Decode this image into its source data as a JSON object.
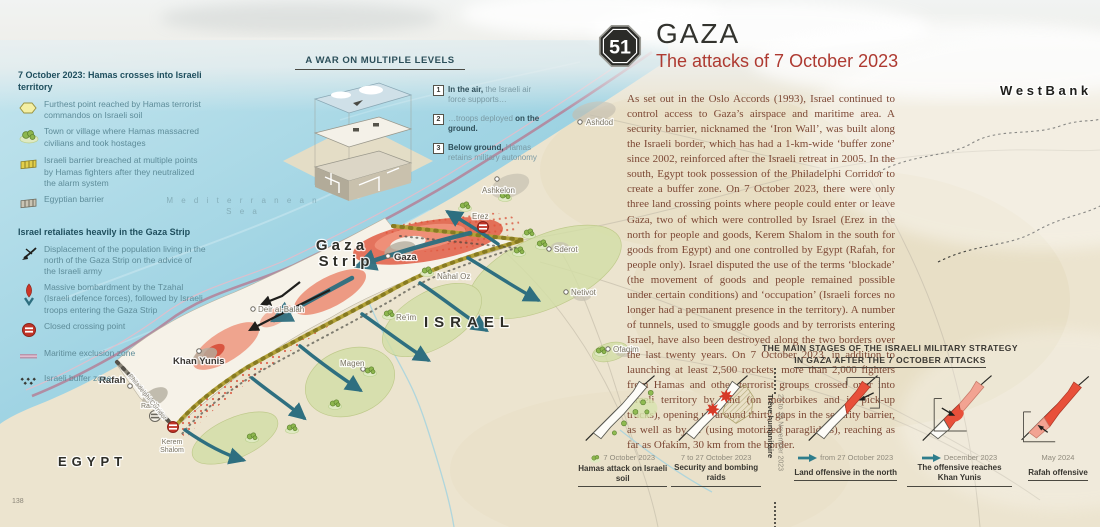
{
  "page": {
    "number": "138"
  },
  "title": {
    "badge": "51",
    "region": "GAZA",
    "subtitle": "The attacks of 7 October 2023"
  },
  "article": {
    "text": "As set out in the Oslo Accords (1993), Israel continued to control access to Gaza’s airspace and maritime area. A security barrier, nicknamed the ‘Iron Wall’, was built along the Israeli border, which has had a 1-km-wide ‘buffer zone’ since 2002, reinforced after the Israeli retreat in 2005. In the south, Egypt took possession of the Philadelphi Corridor to create a buffer zone. On 7 October 2023, there were only three land crossing points where people could enter or leave Gaza, two of which were controlled by Israel (Erez in the north for people and goods, Kerem Shalom in the south for goods from Egypt) and one controlled by Egypt (Rafah, for people only). Israel disputed the use of the terms ‘blockade’ (the movement of goods and people remained possible under certain conditions) and ‘occupation’ (Israeli forces no longer had a permanent presence in the territory). A number of tunnels, used to smuggle goods and by terrorists entering Israel, have also been destroyed along the two borders over the last twenty years. On 7 October 2023, in addition to launching at least 2,500 rockets, more than 2,000 fighters from Hamas and other terrorist groups crossed over into Israeli territory by land (on motorbikes and in pick-up trucks), opening up around thirty gaps in the security barrier, as well as by air (using motorized paragliders), reaching as far as Ofakim, 30 km from the border."
  },
  "legend1": {
    "title": "7 October 2023: Hamas crosses into Israeli territory",
    "items": [
      {
        "icon": "furthest-point",
        "text": "Furthest point reached by Hamas terrorist commandos on Israeli soil"
      },
      {
        "icon": "massacre-town",
        "text": "Town or village where Hamas massacred civilians and took hostages"
      },
      {
        "icon": "israeli-barrier",
        "text": "Israeli barrier breached at multiple points by Hamas fighters after they neutralized the alarm system"
      },
      {
        "icon": "egyptian-barrier",
        "text": "Egyptian barrier"
      }
    ]
  },
  "legend2": {
    "title": "Israel retaliates heavily in the Gaza Strip",
    "items": [
      {
        "icon": "displacement-arrow",
        "text": "Displacement of the population living in the north of the Gaza Strip on the advice of the Israeli army"
      },
      {
        "icon": "bombardment-arrow",
        "text": "Massive bombardment by the Tzahal (Israeli defence forces), followed by Israeli troops entering the Gaza Strip"
      },
      {
        "icon": "closed-crossing",
        "text": "Closed crossing point"
      },
      {
        "icon": "maritime-zone",
        "text": "Maritime exclusion zone"
      },
      {
        "icon": "buffer-zone",
        "text": "Israeli buffer zone"
      }
    ]
  },
  "war_levels": {
    "title": "A WAR ON MULTIPLE LEVELS",
    "items": [
      {
        "num": "1",
        "bold": "In the air,",
        "regular": " the Israeli air force supports…"
      },
      {
        "num": "2",
        "regular": "…troops deployed ",
        "bold": "on the ground."
      },
      {
        "num": "3",
        "bold": "Below ground,",
        "regular": " Hamas retains military autonomy"
      }
    ]
  },
  "map": {
    "labels": {
      "sea1": "M e d i t e r r a n e a n",
      "sea2": "S e a",
      "gaza1": "G a z a",
      "gaza2": "S t r i p",
      "israel": "ISRAEL",
      "egypt": "EGYPT",
      "west_bank": "W e s t   B a n k",
      "gaza_city": "Gaza",
      "khan_yunis": "Khan Yunis",
      "rafah": "Rafah",
      "deir_al_balah": "Deir al-Balah",
      "erez": "Erez",
      "nahal_oz": "Nahal Oz",
      "reim": "Re'im",
      "magen": "Magen",
      "sderot": "Sderot",
      "netivot": "Netivot",
      "ofaqim": "Ofaqim",
      "ashkelon": "Ashkelon",
      "ashdod": "Ashdod",
      "rafah_crossing": "Rafah",
      "kerem1": "Kerem",
      "kerem2": "Shalom",
      "philadelphi": "Philadelphi Corridor"
    }
  },
  "stages": {
    "title_line1": "THE MAIN STAGES OF THE ISRAELI MILITARY STRATEGY",
    "title_line2": "IN GAZA AFTER THE 7 OCTOBER ATTACKS",
    "truce": {
      "date": "24 to 30 November 2023",
      "label": "Trêve humanitaire"
    },
    "items": [
      {
        "date": "7 October 2023",
        "label": "Hamas attack on Israeli soil"
      },
      {
        "date": "7 to 27 October 2023",
        "label": "Security and bombing raids"
      },
      {
        "date": "from 27 October 2023",
        "label": "Land offensive in the north"
      },
      {
        "date": "December 2023",
        "label": "The offensive reaches Khan Yunis"
      },
      {
        "date": "May 2024",
        "label": "Rafah offensive"
      }
    ]
  },
  "colors": {
    "red_zone": "#e0523a",
    "hamas_green": "#8db64e",
    "barrier_yellow": "#b3a23a",
    "teal_arrow": "#2e6f80",
    "title_red": "#ae3a31",
    "sea": "#9cd2e2"
  }
}
